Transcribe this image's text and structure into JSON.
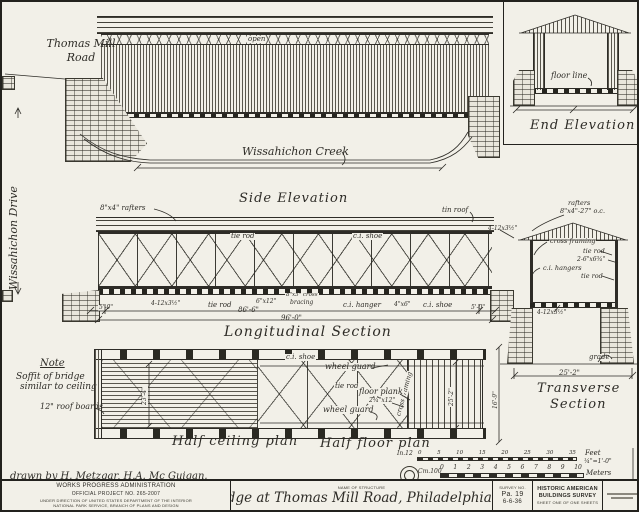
{
  "sheet": {
    "road_label_1": "Thomas Mill",
    "road_label_2": "Road",
    "drive_label": "Wissahichon Drive",
    "creek_label": "Wissahichon Creek",
    "drawn_by": "drawn by H. Metzgar, H.A. Mc Guigan."
  },
  "terms": {
    "tie_rod": "tie rod",
    "ci_shoe": "c.i. shoe",
    "ci_hanger": "c.i. hanger",
    "ci_hangers": "c.i. hangers",
    "cross_framing": "cross framing",
    "wheel_guard": "wheel guard",
    "open": "open",
    "floor_line": "floor line",
    "grade": "grade",
    "tin_roof": "tin roof",
    "floor_plank": "floor plank"
  },
  "sections": {
    "side_elevation": "Side Elevation",
    "end_elevation": "End Elevation",
    "longitudinal": "Longitudinal Section",
    "transverse_1": "Transverse",
    "transverse_2": "Section",
    "half_ceiling": "Half ceiling plan",
    "half_floor": "Half floor plan"
  },
  "labels": {
    "rafters_side": "8\"x4\" rafters",
    "rafters_tr_1": "rafters",
    "rafters_tr_2": "8\"x4\"-27\" o.c.",
    "posts_dim": "4-12x3½\"",
    "beam_2_6x6": "2-6\"x6¾\"",
    "brace_6x12": "6\"x12\"",
    "cross_8x5": "8\"x5\" cross",
    "bracing": "bracing",
    "hanger_4x6": "4\"x6\"",
    "plank_dim": "2¾\"x12\"",
    "roof_boards": "12\" roof boards"
  },
  "note": {
    "heading": "Note",
    "line1": "Soffit of bridge",
    "line2": "similar to ceiling"
  },
  "dims": {
    "d5_0_l": "5'-0\"",
    "d5_0_r": "5'-0\"",
    "d86_6": "86'-6\"",
    "d96_0": "96'-0\"",
    "d25_2": "25'-2\"",
    "d16_9": "16'-9\"",
    "d23_4": "23'-4\"",
    "d25_2_plan": "25'-2\""
  },
  "scale": {
    "in_label": "In.12",
    "in_ticks": [
      "0",
      "5",
      "10",
      "15",
      "20",
      "25",
      "30",
      "35"
    ],
    "feet": "Feet",
    "ratio": "¼\"=1'-0\"",
    "cm_label": "Cm.100",
    "cm_ticks": [
      "0",
      "1",
      "2",
      "3",
      "4",
      "5",
      "6",
      "7",
      "8",
      "9",
      "10"
    ],
    "meters": "Meters"
  },
  "titleblock": {
    "agency_1": "WORKS PROGRESS ADMINISTRATION",
    "agency_2": "OFFICIAL PROJECT NO. 265-2007",
    "agency_3": "UNDER DIRECTION OF UNITED STATES DEPARTMENT OF THE INTERIOR",
    "agency_4": "NATIONAL PARK SERVICE, BRANCH OF PLANS AND DESIGN",
    "name_of_structure": "NAME OF STRUCTURE",
    "structure_name": "Bridge at Thomas Mill Road, Philadelphia Pa.",
    "survey_label": "SURVEY NO.",
    "survey_no": "Pa. 19",
    "survey_date": "6-6-36",
    "habs_1": "HISTORIC AMERICAN",
    "habs_2": "BUILDINGS SURVEY",
    "habs_3": "SHEET ONE OF ONE SHEETS"
  }
}
